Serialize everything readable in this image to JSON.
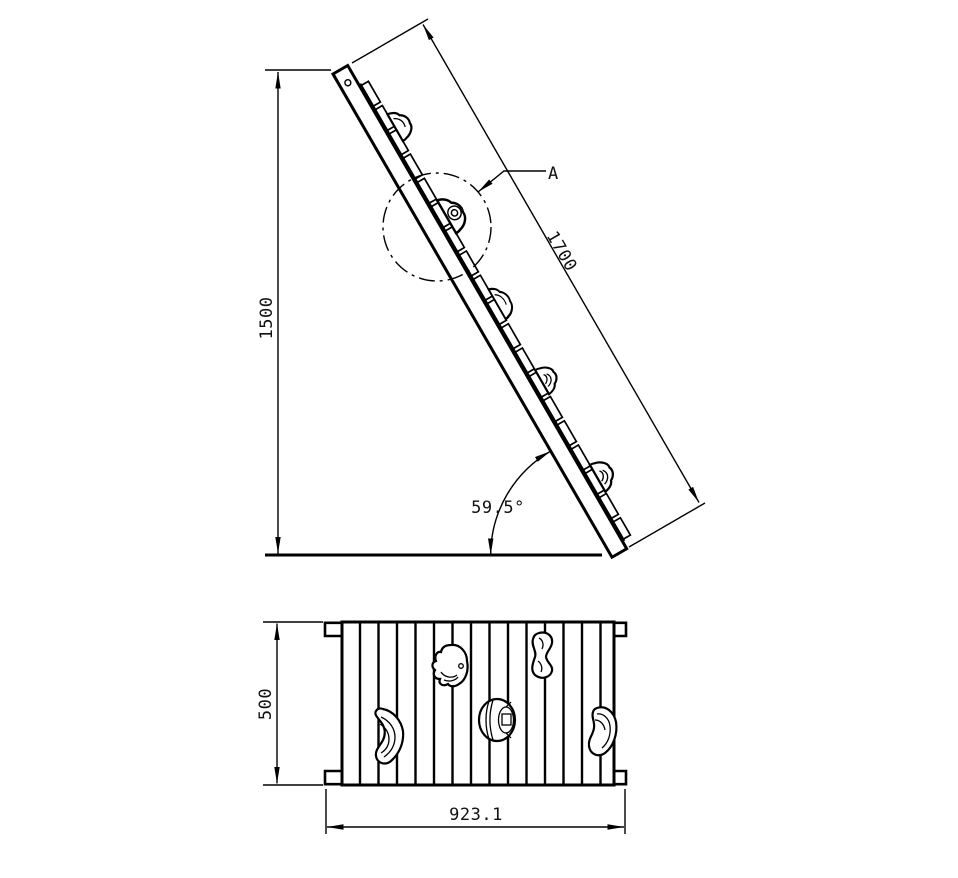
{
  "colors": {
    "line": "#000000",
    "background": "#ffffff",
    "text": "#111111"
  },
  "side_view": {
    "height_dim": "1500",
    "slope_dim": "1700",
    "angle_dim": "59.5°",
    "detail_callout": "A"
  },
  "plan_view": {
    "depth_dim": "500",
    "width_dim": "923.1"
  }
}
